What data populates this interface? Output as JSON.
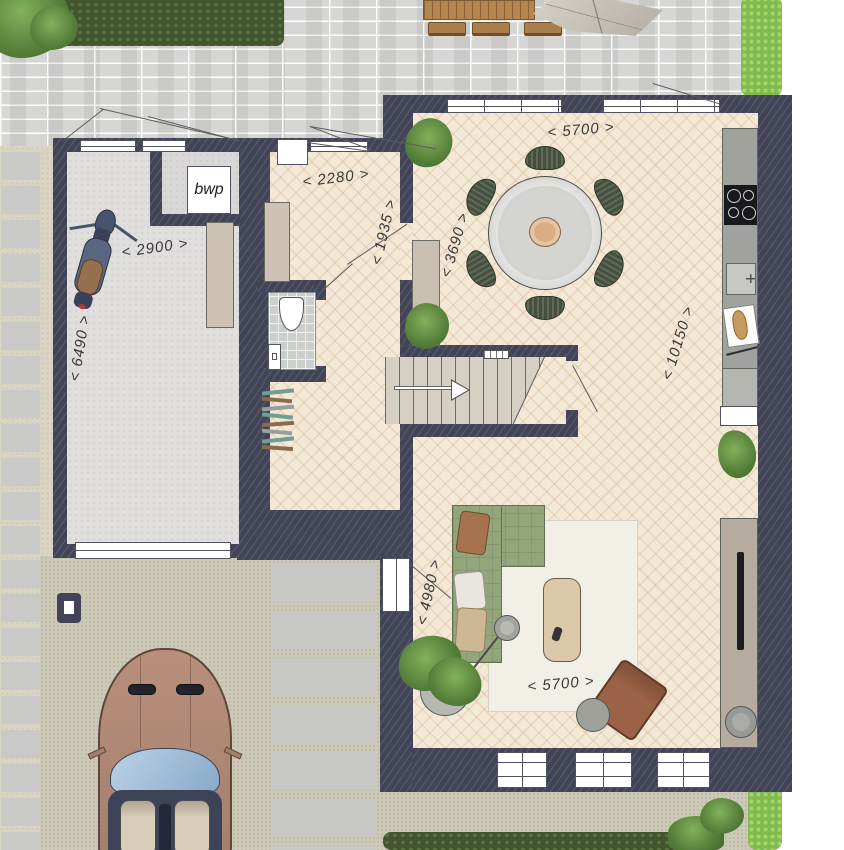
{
  "labels": {
    "heat_pump": "bwp"
  },
  "dims": {
    "garage_width": "< 2900 >",
    "garage_depth": "< 6490 >",
    "hall_width": "< 2280 >",
    "hall_door": "< 1935 >",
    "dining_width": "< 3690 >",
    "living_width_top": "< 5700 >",
    "living_depth": "< 10150 >",
    "sofa_zone_depth": "< 4980 >",
    "living_width_bottom": "< 5700 >"
  },
  "palette": {
    "wall": "#414356",
    "parquet": "#f4e8d6",
    "terrace_brick": "#d6d6d4",
    "garage_floor": "#e0dfdd",
    "gravel": "#cdc9b7",
    "sand": "#dad5c3",
    "tile": "#ccd0cc",
    "stair": "#d6d0c3",
    "hedge_dark": "#42552f",
    "hedge_bright": "#7fbb4d",
    "sofa_green": "#93a57b",
    "chair_green": "#45513c",
    "wood": "#b5854e",
    "counter": "#a0a29e",
    "rug": "#f2efe6",
    "table_gray": "#d4d4d0",
    "beige": "#cec2b4",
    "tv_unit": "#b5ab9e",
    "car_body": "#b18a79",
    "leather": "#9c6245",
    "dim_text": "#3a3a3a"
  }
}
